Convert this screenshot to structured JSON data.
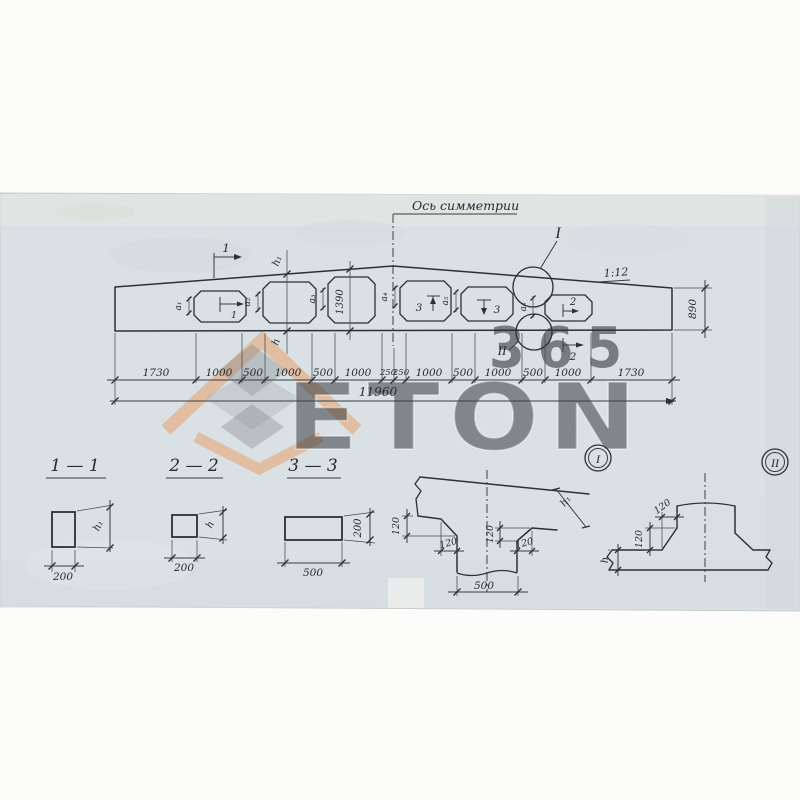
{
  "watermark": {
    "brand": "ETON",
    "number": "365",
    "accent_color": "#e89a5f",
    "gray_color": "#c8ced0"
  },
  "elevation": {
    "axis_label": "Ось симметрии",
    "slope": "1:12",
    "end_height": "890",
    "mid_height": "1390",
    "total": "11960",
    "segments": [
      "1730",
      "1000",
      "500",
      "1000",
      "500",
      "1000",
      "250",
      "250",
      "1000",
      "500",
      "1000",
      "500",
      "1000",
      "1730"
    ],
    "gaps": {
      "a1": "а₁",
      "a2": "а₂",
      "a3": "а₃",
      "a4": "а₄",
      "a5": "а₅",
      "a6": "а₆"
    },
    "marks": {
      "m1": "1",
      "m2": "2",
      "m3": "3"
    },
    "h": "h",
    "h1": "h₁",
    "detail1": "I",
    "detail2": "II"
  },
  "sections": {
    "s11": {
      "title": "1 — 1",
      "width": "200",
      "height": "h₁"
    },
    "s22": {
      "title": "2 — 2",
      "width": "200",
      "height": "h"
    },
    "s33": {
      "title": "3 — 3",
      "width": "500",
      "height": "200"
    }
  },
  "details": {
    "d1": {
      "label": "I",
      "chamfer": "120",
      "width": "500",
      "height": "h₁"
    },
    "d2": {
      "label": "II",
      "chamfer": "120",
      "height": "h"
    }
  }
}
